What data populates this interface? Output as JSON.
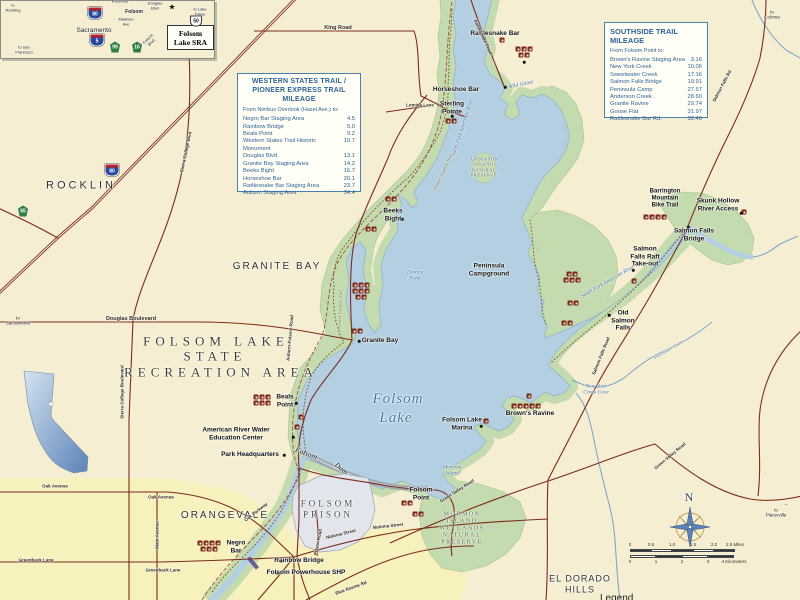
{
  "western_box": {
    "title": "WESTERN STATES TRAIL /\nPIONEER EXPRESS TRAIL MILEAGE",
    "subtitle": "From Nimbus Overlook (Hazel Ave.) to:",
    "items": [
      {
        "name": "Negro Bar Staging Area",
        "mi": "4.5"
      },
      {
        "name": "Rainbow Bridge",
        "mi": "5.0"
      },
      {
        "name": "Beals Point",
        "mi": "9.2"
      },
      {
        "name": "Western States Trail Historic Monument",
        "mi": "10.7"
      },
      {
        "name": "Douglas Blvd.",
        "mi": "13.1"
      },
      {
        "name": "Granite Bay Staging Area",
        "mi": "14.2"
      },
      {
        "name": "Beeks Bight",
        "mi": "16.7"
      },
      {
        "name": "Horseshoe Bar",
        "mi": "20.1"
      },
      {
        "name": "Rattlesnake Bar Staging Area",
        "mi": "23.7"
      },
      {
        "name": "Auburn Staging Area",
        "mi": "34.4"
      }
    ]
  },
  "southside_box": {
    "title": "SOUTHSIDE TRAIL MILEAGE",
    "subtitle": "From Folsom Point to:",
    "items": [
      {
        "name": "Brown's Ravine Staging Area",
        "mi": "3.16"
      },
      {
        "name": "New York Creek",
        "mi": "10.06"
      },
      {
        "name": "Sweetwater Creek",
        "mi": "17.16"
      },
      {
        "name": "Salmon Falls Bridge",
        "mi": "19.91"
      },
      {
        "name": "Peninsula Camp",
        "mi": "27.57"
      },
      {
        "name": "Anderson Creek",
        "mi": "28.60"
      },
      {
        "name": "Granite Ravine",
        "mi": "29.74"
      },
      {
        "name": "Goose Flat",
        "mi": "31.97"
      },
      {
        "name": "Rattlesnake Bar Rd.",
        "mi": "32.46"
      }
    ]
  },
  "inset_sra_label": "Folsom\nLake SRA",
  "compass": {
    "n": "N"
  },
  "legend_label": "Legend",
  "scalebar": {
    "miles": [
      "0",
      "0.5",
      "1.0",
      "1.5",
      "2.0",
      "2.5 Miles"
    ],
    "km": [
      "0",
      "1",
      "2",
      "3",
      "4 Kilometers"
    ]
  },
  "colors": {
    "base": "#f6eed2",
    "lake": "#b4cfe2",
    "parkland": "#c3dbae",
    "road": "#7b2c1c",
    "boxblue": "#2f6496",
    "prison": "#e2e6ec",
    "urban": "#f7f1bd"
  },
  "shields": [
    {
      "n": "interstate-80-shield",
      "t": "80",
      "x": 112,
      "y": 170,
      "k": "interstate"
    },
    {
      "n": "state-route-65-shield",
      "t": "65",
      "x": 23,
      "y": 211,
      "k": "state"
    },
    {
      "n": "inset-interstate-80-shield",
      "t": "80",
      "x": 95,
      "y": 13,
      "k": "interstate"
    },
    {
      "n": "inset-interstate-5-shield",
      "t": "5",
      "x": 97,
      "y": 40,
      "k": "interstate"
    },
    {
      "n": "inset-state-route-99-shield",
      "t": "99",
      "x": 115,
      "y": 47,
      "k": "state"
    },
    {
      "n": "inset-state-route-16-shield",
      "t": "16",
      "x": 137,
      "y": 47,
      "k": "state"
    },
    {
      "n": "inset-us-50-shield",
      "t": "50",
      "x": 196,
      "y": 21,
      "k": "us"
    }
  ],
  "map_labels": [
    {
      "n": "label-rocklin",
      "t": "ROCKLIN",
      "x": 81,
      "y": 186,
      "c": "region-lg"
    },
    {
      "n": "label-granite-bay-region",
      "t": "GRANITE BAY",
      "x": 277,
      "y": 267,
      "c": "region"
    },
    {
      "n": "label-orangevale",
      "t": "ORANGEVALE",
      "x": 225,
      "y": 516,
      "c": "region"
    },
    {
      "n": "label-el-dorado-hills",
      "t": "EL DORADO\nHILLS",
      "x": 580,
      "y": 584,
      "c": "region-sm"
    },
    {
      "n": "label-title-folsom-lake",
      "t": "FOLSOM LAKE",
      "x": 216,
      "y": 341,
      "c": "title-serif"
    },
    {
      "n": "label-title-state",
      "t": "STATE",
      "x": 215,
      "y": 356,
      "c": "title-serif"
    },
    {
      "n": "label-title-recreation-area",
      "t": "RECREATION AREA",
      "x": 221,
      "y": 372,
      "c": "title-serif"
    },
    {
      "n": "label-folsom-prison",
      "t": "FOLSOM\nPRISON",
      "x": 328,
      "y": 509,
      "c": "prison"
    },
    {
      "n": "label-mormon-island-preserve",
      "t": "MORMON\nISLAND\nWETLANDS\nNATURAL\nPRESERVE",
      "x": 462,
      "y": 529,
      "c": "preserve"
    },
    {
      "n": "label-anderson-island-preserve",
      "t": "ANDERSON\nISLAND\nNATURAL\nPRESERVE",
      "x": 484,
      "y": 167,
      "c": "preserve-sm"
    },
    {
      "n": "label-folsom-lake-1",
      "t": "Folsom",
      "x": 398,
      "y": 400,
      "c": "water-lg"
    },
    {
      "n": "label-folsom-lake-2",
      "t": "Lake",
      "x": 396,
      "y": 419,
      "c": "water-lg"
    },
    {
      "n": "label-dotons-point",
      "t": "Dotons\nPoint",
      "x": 415,
      "y": 276,
      "c": "water"
    },
    {
      "n": "label-mormon-island",
      "t": "Mormon\nIsland",
      "x": 452,
      "y": 471,
      "c": "water"
    },
    {
      "n": "label-new-york-creek-cove",
      "t": "New York\nCreek Cove",
      "x": 596,
      "y": 390,
      "c": "water"
    },
    {
      "n": "label-wild-goose",
      "t": "Wild Goose",
      "x": 521,
      "y": 85,
      "c": "water",
      "r": -12
    },
    {
      "n": "label-north-fork-american-river",
      "t": "North Fork American River",
      "x": 463,
      "y": 128,
      "c": "water",
      "r": -72
    },
    {
      "n": "label-south-fork-american-river",
      "t": "South Fork American River",
      "x": 608,
      "y": 282,
      "c": "water",
      "r": -30
    },
    {
      "n": "label-rattlesnake-bar",
      "t": "Rattlesnake Bar",
      "x": 495,
      "y": 34,
      "c": "place"
    },
    {
      "n": "label-horseshoe-bar",
      "t": "Horseshoe Bar",
      "x": 456,
      "y": 90,
      "c": "place"
    },
    {
      "n": "label-sterling-pointe",
      "t": "Sterling\nPointe",
      "x": 452,
      "y": 108,
      "c": "place"
    },
    {
      "n": "label-beeks-bight",
      "t": "Beeks\nBight",
      "x": 393,
      "y": 215,
      "c": "place"
    },
    {
      "n": "label-peninsula-campground",
      "t": "Peninsula\nCampground",
      "x": 489,
      "y": 270,
      "c": "place"
    },
    {
      "n": "label-granite-bay",
      "t": "Granite Bay",
      "x": 380,
      "y": 341,
      "c": "place"
    },
    {
      "n": "label-beals-point",
      "t": "Beals\nPoint",
      "x": 285,
      "y": 401,
      "c": "place"
    },
    {
      "n": "label-american-river-water-education-center",
      "t": "American River Water\nEducation Center",
      "x": 236,
      "y": 434,
      "c": "place"
    },
    {
      "n": "label-park-headquarters",
      "t": "Park Headquarters",
      "x": 250,
      "y": 455,
      "c": "place"
    },
    {
      "n": "label-negro-bar",
      "t": "Negro\nBar",
      "x": 236,
      "y": 547,
      "c": "place"
    },
    {
      "n": "label-rainbow-bridge",
      "t": "Rainbow Bridge",
      "x": 299,
      "y": 561,
      "c": "place"
    },
    {
      "n": "label-folsom-powerhouse-shp",
      "t": "Folsom Powerhouse SHP",
      "x": 306,
      "y": 573,
      "c": "place"
    },
    {
      "n": "label-folsom-point",
      "t": "Folsom\nPoint",
      "x": 421,
      "y": 494,
      "c": "place"
    },
    {
      "n": "label-folsom-lake-marina",
      "t": "Folsom Lake\nMarina",
      "x": 462,
      "y": 424,
      "c": "place"
    },
    {
      "n": "label-browns-ravine",
      "t": "Brown's Ravine",
      "x": 530,
      "y": 414,
      "c": "place"
    },
    {
      "n": "label-old-salmon-falls",
      "t": "Old\nSalmon\nFalls",
      "x": 623,
      "y": 321,
      "c": "place"
    },
    {
      "n": "label-salmon-falls-bridge",
      "t": "Salmon Falls\nBridge",
      "x": 694,
      "y": 235,
      "c": "place"
    },
    {
      "n": "label-salmon-falls-raft-take-out",
      "t": "Salmon\nFalls Raft\nTake-out",
      "x": 645,
      "y": 257,
      "c": "place"
    },
    {
      "n": "label-skunk-hollow-river-access",
      "t": "Skunk Hollow\nRiver Access",
      "x": 718,
      "y": 205,
      "c": "place"
    },
    {
      "n": "label-barrington-mountain-bike-trail",
      "t": "Barrington\nMountain\nBike Trail",
      "x": 665,
      "y": 199,
      "c": "place-sm"
    },
    {
      "n": "label-folsom-dam-1",
      "t": "Folsom",
      "x": 306,
      "y": 454,
      "c": "dam",
      "r": 20
    },
    {
      "n": "label-folsom-dam-2",
      "t": "Dam",
      "x": 341,
      "y": 469,
      "c": "dam",
      "r": 38
    },
    {
      "n": "label-king-road",
      "t": "King Road",
      "x": 338,
      "y": 28,
      "c": "road"
    },
    {
      "n": "label-lomida-lane",
      "t": "Lomida Lane",
      "x": 420,
      "y": 105,
      "c": "road-sm"
    },
    {
      "n": "label-rattlesnake-road",
      "t": "Rattlesnake Road",
      "x": 483,
      "y": 37,
      "c": "road-sm",
      "r": 65
    },
    {
      "n": "label-douglas-boulevard",
      "t": "Douglas Boulevard",
      "x": 131,
      "y": 319,
      "c": "road"
    },
    {
      "n": "label-sierra-college-boulevard",
      "t": "Sierra College Boulevard",
      "x": 122,
      "y": 392,
      "c": "road-sm",
      "r": -90
    },
    {
      "n": "label-sierra-college-blvd-north",
      "t": "Sierra College Blvd",
      "x": 186,
      "y": 152,
      "c": "road-sm",
      "r": -78
    },
    {
      "n": "label-auburn-folsom-road",
      "t": "Auburn-Folsom Road",
      "x": 290,
      "y": 338,
      "c": "road-sm",
      "r": -85
    },
    {
      "n": "label-oak-avenue-west",
      "t": "Oak Avenue",
      "x": 55,
      "y": 486,
      "c": "road-sm"
    },
    {
      "n": "label-oak-avenue-east",
      "t": "Oak Avenue",
      "x": 161,
      "y": 497,
      "c": "road-sm"
    },
    {
      "n": "label-main-avenue",
      "t": "Main Avenue",
      "x": 157,
      "y": 535,
      "c": "road-sm",
      "r": -90
    },
    {
      "n": "label-greenback-lane-west",
      "t": "Greenback  Lane",
      "x": 36,
      "y": 560,
      "c": "road-sm"
    },
    {
      "n": "label-greenback-lane-east",
      "t": "Greenback  Lane",
      "x": 163,
      "y": 570,
      "c": "road-sm"
    },
    {
      "n": "label-oak-parkway",
      "t": "Oak Parkway",
      "x": 256,
      "y": 512,
      "c": "road-sm",
      "r": -38
    },
    {
      "n": "label-natoma-street-1",
      "t": "Natoma Street",
      "x": 341,
      "y": 534,
      "c": "road-sm",
      "r": -14
    },
    {
      "n": "label-natoma-street-2",
      "t": "Natoma Street",
      "x": 388,
      "y": 526,
      "c": "road-sm",
      "r": -6
    },
    {
      "n": "label-blue-ravine-rd",
      "t": "Blue Ravine Rd",
      "x": 351,
      "y": 588,
      "c": "road-sm",
      "r": -20
    },
    {
      "n": "label-prison-road",
      "t": "Prison Road",
      "x": 318,
      "y": 542,
      "c": "road-sm",
      "r": -78
    },
    {
      "n": "label-green-valley-road-west",
      "t": "Green Valley Road",
      "x": 457,
      "y": 491,
      "c": "road-sm",
      "r": -33
    },
    {
      "n": "label-green-valley-road-east",
      "t": "Green Valley Road",
      "x": 670,
      "y": 456,
      "c": "road-sm",
      "r": -40
    },
    {
      "n": "label-salmon-falls-road",
      "t": "Salmon  Falls  Road",
      "x": 601,
      "y": 356,
      "c": "road-sm",
      "r": -68
    },
    {
      "n": "label-salmon-falls-rd-north",
      "t": "Salmon Falls Rd",
      "x": 722,
      "y": 86,
      "c": "road-sm",
      "r": -62
    },
    {
      "n": "label-pioneer-express-trail-ne",
      "t": "Pioneer Express Trail",
      "x": 443,
      "y": 172,
      "c": "trail",
      "r": -65
    },
    {
      "n": "label-pioneer-express-trail-w",
      "t": "Pioneer Express Trail",
      "x": 340,
      "y": 310,
      "c": "trail",
      "r": -88
    },
    {
      "n": "label-sweetwater-creek",
      "t": "Sweetwater Creek",
      "x": 668,
      "y": 350,
      "c": "creek",
      "r": -30
    },
    {
      "n": "label-to-sacramento",
      "t": "to\nSacramento",
      "x": 18,
      "y": 321,
      "c": "dir"
    },
    {
      "n": "label-to-placerville-arrow",
      "t": "→",
      "x": 786,
      "y": 504,
      "c": "dir"
    },
    {
      "n": "label-to-placerville",
      "t": "to\nPlacerville",
      "x": 776,
      "y": 513,
      "c": "dir"
    },
    {
      "n": "label-to-coloma",
      "t": "to\nColoma",
      "x": 772,
      "y": 15,
      "c": "dir"
    },
    {
      "n": "inset-roseville",
      "t": "Roseville",
      "x": 120,
      "y": 2,
      "c": "ins"
    },
    {
      "n": "inset-to-redding",
      "t": "to\nRedding",
      "x": 13,
      "y": 8,
      "c": "ins"
    },
    {
      "n": "inset-douglas-blvd",
      "t": "Douglas\nBlvd",
      "x": 155,
      "y": 6,
      "c": "ins"
    },
    {
      "n": "inset-folsom",
      "t": "Folsom",
      "x": 134,
      "y": 13,
      "c": "ins-md"
    },
    {
      "n": "inset-madison-ave",
      "t": "Madison\nAve",
      "x": 126,
      "y": 22,
      "c": "ins"
    },
    {
      "n": "inset-sacramento",
      "t": "Sacramento",
      "x": 94,
      "y": 31,
      "c": "ins-lg"
    },
    {
      "n": "inset-to-san-francisco",
      "t": "to San\nFrancisco",
      "x": 24,
      "y": 50,
      "c": "ins"
    },
    {
      "n": "inset-to-lake-tahoe",
      "t": "to Lake\nTahoe",
      "x": 200,
      "y": 12,
      "c": "ins"
    },
    {
      "n": "inset-folsom-blvd",
      "t": "Folsom\nBlvd",
      "x": 150,
      "y": 41,
      "c": "ins",
      "r": -45
    },
    {
      "n": "inset-star-icon",
      "t": "★",
      "x": 172,
      "y": 7,
      "c": "star-b"
    },
    {
      "n": "california-star-icon",
      "t": "★",
      "x": 51,
      "y": 404,
      "c": "star-w"
    }
  ],
  "icon_clusters": [
    {
      "n": "amenity-icons-rattlesnake-bar",
      "x": 502,
      "y": 40,
      "rows": [
        1
      ]
    },
    {
      "n": "amenity-icons-north-cove",
      "x": 524,
      "y": 52,
      "rows": [
        3,
        2
      ]
    },
    {
      "n": "amenity-icons-sterling-pointe",
      "x": 451,
      "y": 121,
      "rows": [
        2
      ]
    },
    {
      "n": "amenity-icons-beeks-bight",
      "x": 391,
      "y": 199,
      "rows": [
        2
      ]
    },
    {
      "n": "amenity-icons-shore-north",
      "x": 371,
      "y": 229,
      "rows": [
        2
      ]
    },
    {
      "n": "amenity-icons-granite-bay-shore",
      "x": 361,
      "y": 291,
      "rows": [
        3,
        3,
        2
      ]
    },
    {
      "n": "amenity-icons-granite-bay",
      "x": 357,
      "y": 331,
      "rows": [
        2
      ]
    },
    {
      "n": "amenity-icons-beals-point",
      "x": 262,
      "y": 400,
      "rows": [
        3,
        3
      ]
    },
    {
      "n": "amenity-icons-negro-bar",
      "x": 209,
      "y": 546,
      "rows": [
        4,
        3
      ]
    },
    {
      "n": "amenity-icons-folsom-point-1",
      "x": 407,
      "y": 503,
      "rows": [
        2
      ]
    },
    {
      "n": "amenity-icons-folsom-point-2",
      "x": 418,
      "y": 514,
      "rows": [
        2
      ]
    },
    {
      "n": "anchor-icon-marina",
      "x": 486,
      "y": 421,
      "rows": [
        1
      ]
    },
    {
      "n": "amenity-icons-browns-ravine-tent",
      "x": 529,
      "y": 396,
      "rows": [
        1
      ]
    },
    {
      "n": "amenity-icons-browns-ravine",
      "x": 526,
      "y": 406,
      "rows": [
        5
      ]
    },
    {
      "n": "amenity-icons-peninsula",
      "x": 572,
      "y": 277,
      "rows": [
        2,
        3
      ]
    },
    {
      "n": "amenity-icons-old-salmon-falls-1",
      "x": 573,
      "y": 303,
      "rows": [
        2
      ]
    },
    {
      "n": "amenity-icons-old-salmon-falls-2",
      "x": 567,
      "y": 323,
      "rows": [
        2
      ]
    },
    {
      "n": "amenity-icons-salmon-falls-bridge",
      "x": 655,
      "y": 217,
      "rows": [
        4
      ]
    },
    {
      "n": "amenity-icons-skunk-hollow",
      "x": 744,
      "y": 212,
      "rows": [
        1
      ]
    },
    {
      "n": "amenity-icons-raft-take-out",
      "x": 634,
      "y": 281,
      "rows": [
        1
      ]
    },
    {
      "n": "amenity-icons-beals-shore-1",
      "x": 301,
      "y": 417,
      "rows": [
        1
      ]
    },
    {
      "n": "amenity-icons-beals-shore-2",
      "x": 297,
      "y": 427,
      "rows": [
        1
      ]
    }
  ],
  "dots": [
    [
      402,
      219
    ],
    [
      359,
      341
    ],
    [
      296,
      403
    ],
    [
      281,
      561
    ],
    [
      277,
      573
    ],
    [
      481,
      426
    ],
    [
      452,
      116
    ],
    [
      284,
      455
    ],
    [
      293,
      437
    ],
    [
      609,
      315
    ],
    [
      741,
      213
    ],
    [
      505,
      87
    ],
    [
      524,
      62
    ],
    [
      633,
      270
    ],
    [
      688,
      227
    ]
  ]
}
